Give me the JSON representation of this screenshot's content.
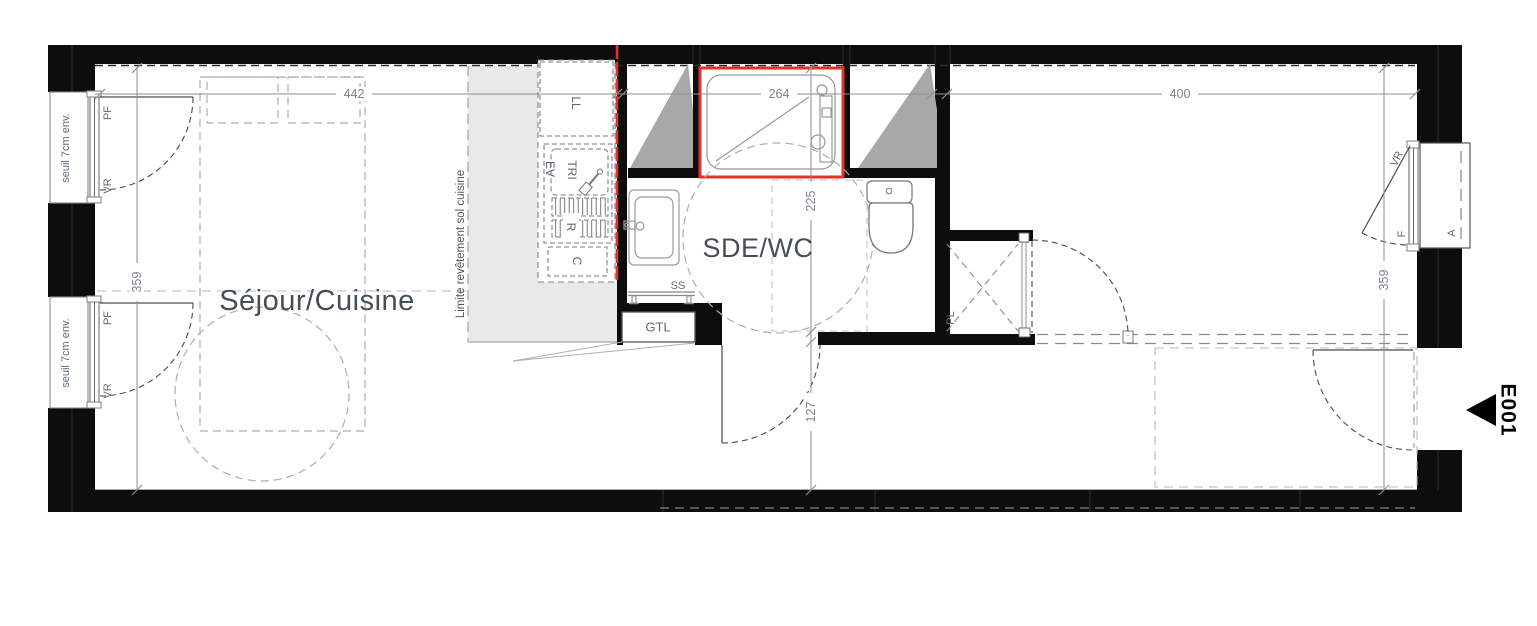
{
  "rooms": {
    "sejour": "Séjour/Cuisine",
    "sde": "SDE/WC"
  },
  "dimensions": {
    "sejour_width": "442",
    "sde_width": "264",
    "right_width": "400",
    "left_depth": "359",
    "right_depth": "359",
    "sde_depth": "225",
    "hall_depth": "127"
  },
  "window_labels": {
    "pf": "PF",
    "vr": "VR",
    "seuil": "seuil 7cm env."
  },
  "kitchen": {
    "limit_note": "Limite revêtement sol cuisine",
    "washer": "LL",
    "sorting": "TRI",
    "sink": "EV",
    "fridge": "R",
    "cooktop": "C"
  },
  "fixtures": {
    "towel_rail": "SS",
    "duct": "GTL",
    "closet": "PL"
  },
  "right_side": {
    "window": "F",
    "shutter": "VR",
    "railing": "A"
  },
  "entrance": {
    "code": "E001"
  },
  "colors": {
    "wall": "#0d0d0d",
    "red": "#e5312b",
    "kitchen_floor": "#e9e9e8",
    "duct_gray": "#a8a8a8"
  }
}
